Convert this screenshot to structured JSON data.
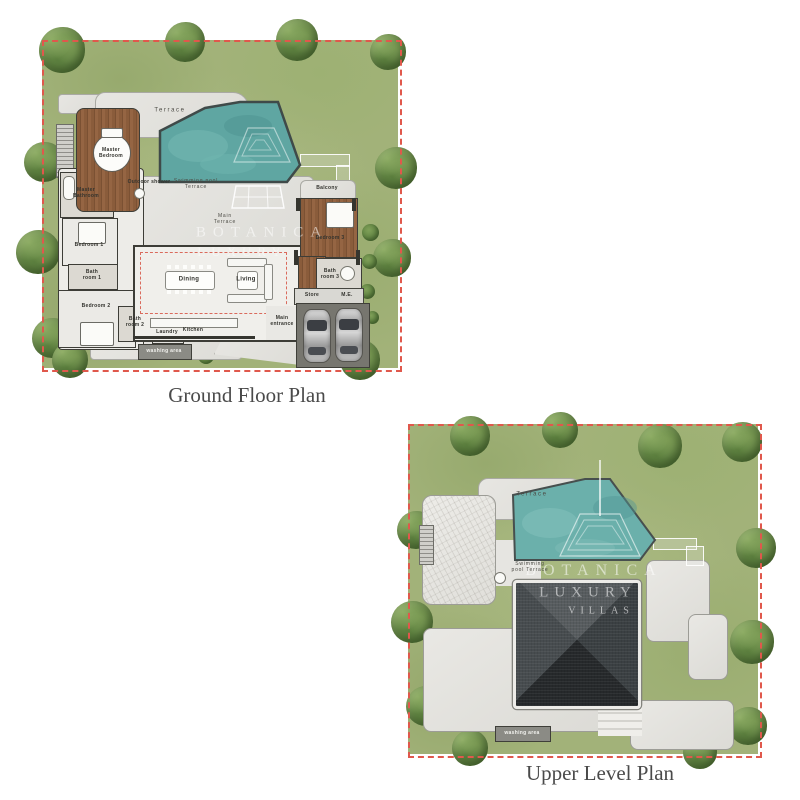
{
  "captions": {
    "ground": "Ground Floor Plan",
    "upper": "Upper Level Plan"
  },
  "watermark": {
    "line1": "BOTANICA",
    "line2": "LUXURY",
    "line3": "VILLAS"
  },
  "ground_plan": {
    "labels": {
      "terrace": "Terrace",
      "swimming_pool_terrace": "Swimming pool Terrace",
      "main_terrace": "Main Terrace",
      "master_bedroom": "Master Bedroom",
      "master_bathroom": "Master Bathroom",
      "outdoor_shower": "Outdoor shower",
      "bedroom_1": "Bedroom 1",
      "bath_room_1": "Bath room 1",
      "bedroom_2": "Bedroom 2",
      "bath_room_2": "Bath room 2",
      "bedroom_3": "Bedroom 3",
      "bath_room_3": "Bath room 3",
      "balcony": "Balcony",
      "dining": "Dining",
      "living": "Living",
      "kitchen": "Kitchen",
      "laundry": "Laundry",
      "store": "Store",
      "me_room": "M.E.",
      "main_entrance": "Main entrance",
      "washing_area": "washing area"
    }
  },
  "upper_plan": {
    "labels": {
      "terrace": "Terrace",
      "swimming_pool_terrace": "Swimming pool Terrace",
      "washing_area": "washing area"
    }
  },
  "colors": {
    "lawn": "#a2b279",
    "tree_foliage": "#6d8f4e",
    "pool_water": "#5fa6a2",
    "wood_deck": "#8a5c3b",
    "stone_terrace": "#e4e3df",
    "roof_pyramid": "#3c4144",
    "plot_boundary_dash": "#e0584c"
  }
}
